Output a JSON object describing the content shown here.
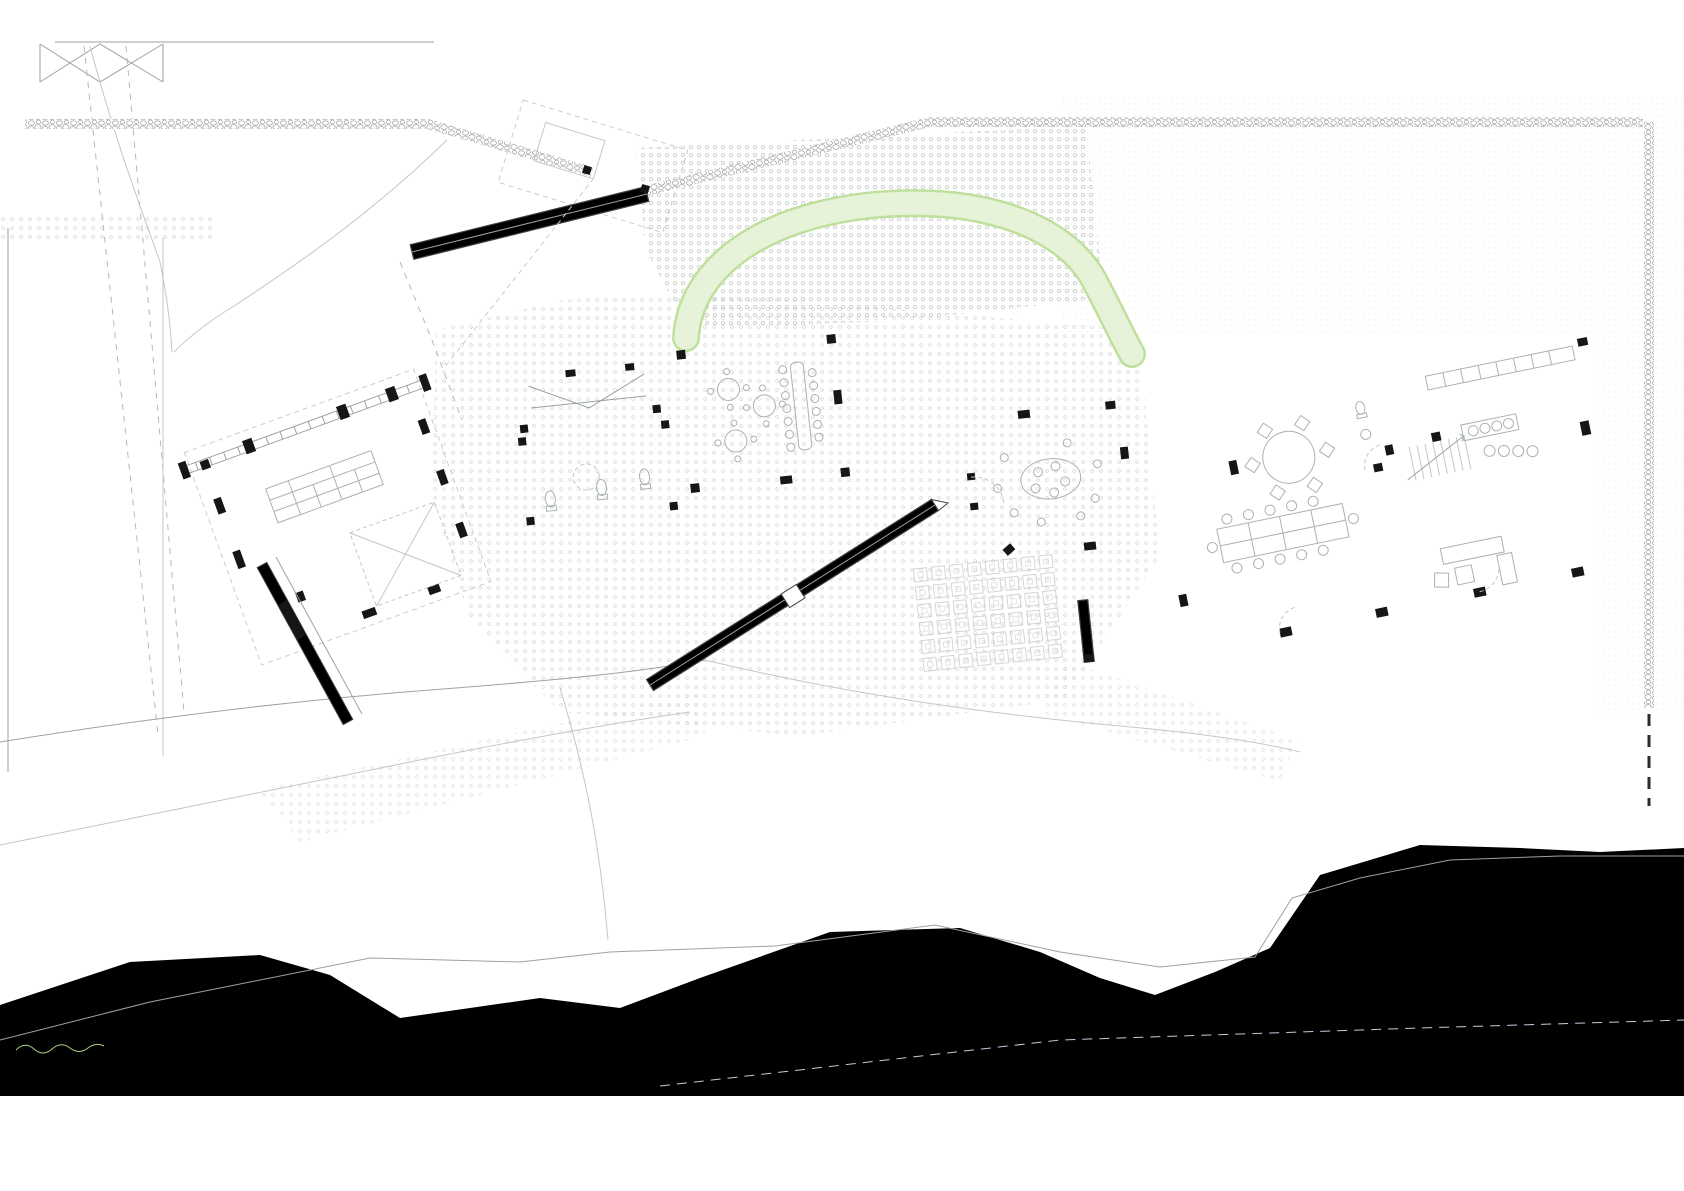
{
  "meta": {
    "drawing": "architectural-site-plan"
  },
  "labels": {
    "pedestrian_entrance": "INGRESO PEATONAL",
    "ramp_slope": "10%"
  },
  "colors": {
    "wall-dark": "#3f4345",
    "wall-fill": "#b6c0ba",
    "tree-line": "#9ed174",
    "tree-faint": "#cbe6ad",
    "tree-mid": "#b7db93",
    "tree-fill": "#eef6e2",
    "tree-fill2": "#ddeec6",
    "tree-dot": "#5fc72e",
    "water": "#e0e3f4",
    "boundary": "#2730d8",
    "glazing": "#9db1e6",
    "ramp-fill": "#c9d1cd",
    "stone": "#8d9491",
    "hedge": "#9bc878",
    "paper-cream": "#efe8dc"
  },
  "compass": {
    "cx": 48,
    "cy": 1139,
    "r": 25,
    "needle_x": 27.5,
    "needle_y": 1126
  },
  "parking": {
    "dividers_y": [
      238,
      312,
      386,
      460,
      534,
      608,
      682,
      756
    ],
    "vehicles": [
      {
        "type": "bus",
        "x": 22,
        "y": 246
      },
      {
        "type": "bus",
        "x": 22,
        "y": 320
      },
      {
        "type": "car",
        "x": 26,
        "y": 396
      },
      {
        "type": "car",
        "x": 26,
        "y": 468
      },
      {
        "type": "bus",
        "x": 22,
        "y": 540
      },
      {
        "type": "car",
        "x": 26,
        "y": 616
      },
      {
        "type": "bus",
        "x": 22,
        "y": 686
      }
    ],
    "street_car": {
      "x": 299,
      "y": 38
    }
  },
  "trees": [
    {
      "x": 214,
      "y": 137,
      "r": 26,
      "k": "outline",
      "d": 2
    },
    {
      "x": 352,
      "y": 237,
      "r": 34,
      "k": "faint",
      "d": 0
    },
    {
      "x": 299,
      "y": 303,
      "r": 24,
      "k": "faint",
      "d": 0
    },
    {
      "x": 219,
      "y": 313,
      "r": 15,
      "k": "dense",
      "d": 1
    },
    {
      "x": 719,
      "y": 172,
      "r": 30,
      "k": "outline",
      "d": 2
    },
    {
      "x": 753,
      "y": 198,
      "r": 16,
      "k": "dense",
      "d": 1
    },
    {
      "x": 966,
      "y": 207,
      "r": 26,
      "k": "outline",
      "d": 2
    },
    {
      "x": 1160,
      "y": 150,
      "r": 30,
      "k": "outline",
      "d": 2
    },
    {
      "x": 1282,
      "y": 148,
      "r": 32,
      "k": "outline",
      "d": 2
    },
    {
      "x": 1513,
      "y": 146,
      "r": 32,
      "k": "outline",
      "d": 2
    },
    {
      "x": 1310,
      "y": 233,
      "r": 28,
      "k": "faint",
      "d": 1
    },
    {
      "x": 1451,
      "y": 232,
      "r": 28,
      "k": "faint",
      "d": 1
    },
    {
      "x": 1586,
      "y": 233,
      "r": 28,
      "k": "faint",
      "d": 1
    },
    {
      "x": 1205,
      "y": 222,
      "r": 13,
      "k": "dense",
      "d": 1
    },
    {
      "x": 1228,
      "y": 246,
      "r": 16,
      "k": "dense",
      "d": 1
    },
    {
      "x": 1625,
      "y": 96,
      "r": 22,
      "k": "faint",
      "d": 0
    },
    {
      "x": 1044,
      "y": 185,
      "r": 62,
      "k": "faint",
      "d": 0,
      "branches": true
    },
    {
      "x": 878,
      "y": 298,
      "r": 26,
      "k": "hatch",
      "d": 1
    },
    {
      "x": 782,
      "y": 292,
      "r": 22,
      "k": "hatch",
      "d": 1
    },
    {
      "x": 941,
      "y": 313,
      "r": 17,
      "k": "hatch",
      "d": 1
    },
    {
      "x": 1048,
      "y": 268,
      "r": 20,
      "k": "hatch",
      "d": 1
    },
    {
      "x": 1090,
      "y": 240,
      "r": 24,
      "k": "hatch",
      "d": 1
    },
    {
      "x": 830,
      "y": 251,
      "r": 16,
      "k": "faint",
      "d": 0
    },
    {
      "x": 690,
      "y": 300,
      "r": 18,
      "k": "faint",
      "d": 0
    },
    {
      "x": 628,
      "y": 672,
      "r": 12,
      "k": "outline",
      "d": 1
    },
    {
      "x": 117,
      "y": 957,
      "r": 52,
      "k": "outline",
      "d": 2
    },
    {
      "x": 108,
      "y": 888,
      "r": 40,
      "k": "faint",
      "d": 2
    },
    {
      "x": 165,
      "y": 752,
      "r": 38,
      "k": "dense",
      "d": 1
    },
    {
      "x": 112,
      "y": 788,
      "r": 30,
      "k": "dense",
      "d": 0
    },
    {
      "x": 315,
      "y": 838,
      "r": 44,
      "k": "outline",
      "d": 2
    },
    {
      "x": 423,
      "y": 692,
      "r": 36,
      "k": "dense",
      "d": 1
    },
    {
      "x": 557,
      "y": 745,
      "r": 27,
      "k": "dense",
      "d": 1
    },
    {
      "x": 605,
      "y": 740,
      "r": 20,
      "k": "faint",
      "d": 1
    },
    {
      "x": 845,
      "y": 820,
      "r": 32,
      "k": "outline",
      "d": 2
    },
    {
      "x": 935,
      "y": 745,
      "r": 14,
      "k": "faint",
      "d": 1
    },
    {
      "x": 1022,
      "y": 752,
      "r": 28,
      "k": "dense",
      "d": 1
    },
    {
      "x": 1082,
      "y": 742,
      "r": 24,
      "k": "dense",
      "d": 1
    },
    {
      "x": 1135,
      "y": 762,
      "r": 28,
      "k": "dense",
      "d": 1
    },
    {
      "x": 1197,
      "y": 778,
      "r": 24,
      "k": "dense",
      "d": 1
    },
    {
      "x": 1247,
      "y": 800,
      "r": 44,
      "k": "outline",
      "d": 2
    },
    {
      "x": 1330,
      "y": 785,
      "r": 28,
      "k": "faint",
      "d": 0
    },
    {
      "x": 1590,
      "y": 718,
      "r": 40,
      "k": "dense",
      "d": 1
    },
    {
      "x": 1547,
      "y": 770,
      "r": 15,
      "k": "dense",
      "d": 1
    },
    {
      "x": 1575,
      "y": 828,
      "r": 36,
      "k": "dense",
      "d": 1
    },
    {
      "x": 1462,
      "y": 838,
      "r": 40,
      "k": "outline",
      "d": 2
    },
    {
      "x": 1653,
      "y": 790,
      "r": 0,
      "k": "dotonly",
      "d": 2
    },
    {
      "x": 45,
      "y": 760,
      "r": 30,
      "k": "faint",
      "d": 0
    },
    {
      "x": 30,
      "y": 960,
      "r": 26,
      "k": "faint",
      "d": 0
    }
  ],
  "sprigs": [
    [
      557,
      348
    ],
    [
      627,
      358
    ],
    [
      680,
      353
    ],
    [
      545,
      735
    ],
    [
      588,
      728
    ],
    [
      75,
      772
    ],
    [
      140,
      735
    ],
    [
      930,
      742
    ],
    [
      1163,
      757
    ],
    [
      700,
      250
    ],
    [
      872,
      256
    ],
    [
      985,
      300
    ],
    [
      1105,
      528
    ],
    [
      1180,
      690
    ],
    [
      1478,
      700
    ],
    [
      1302,
      756
    ],
    [
      620,
      300
    ]
  ],
  "people": [
    [
      295,
      820
    ],
    [
      355,
      775
    ],
    [
      388,
      757
    ],
    [
      848,
      563
    ]
  ],
  "bollards": [
    [
      341,
      254,
      20
    ],
    [
      466,
      327,
      20
    ],
    [
      497,
      113,
      35
    ]
  ],
  "wall_dots": [
    [
      1143,
      508
    ],
    [
      1172,
      513
    ]
  ]
}
